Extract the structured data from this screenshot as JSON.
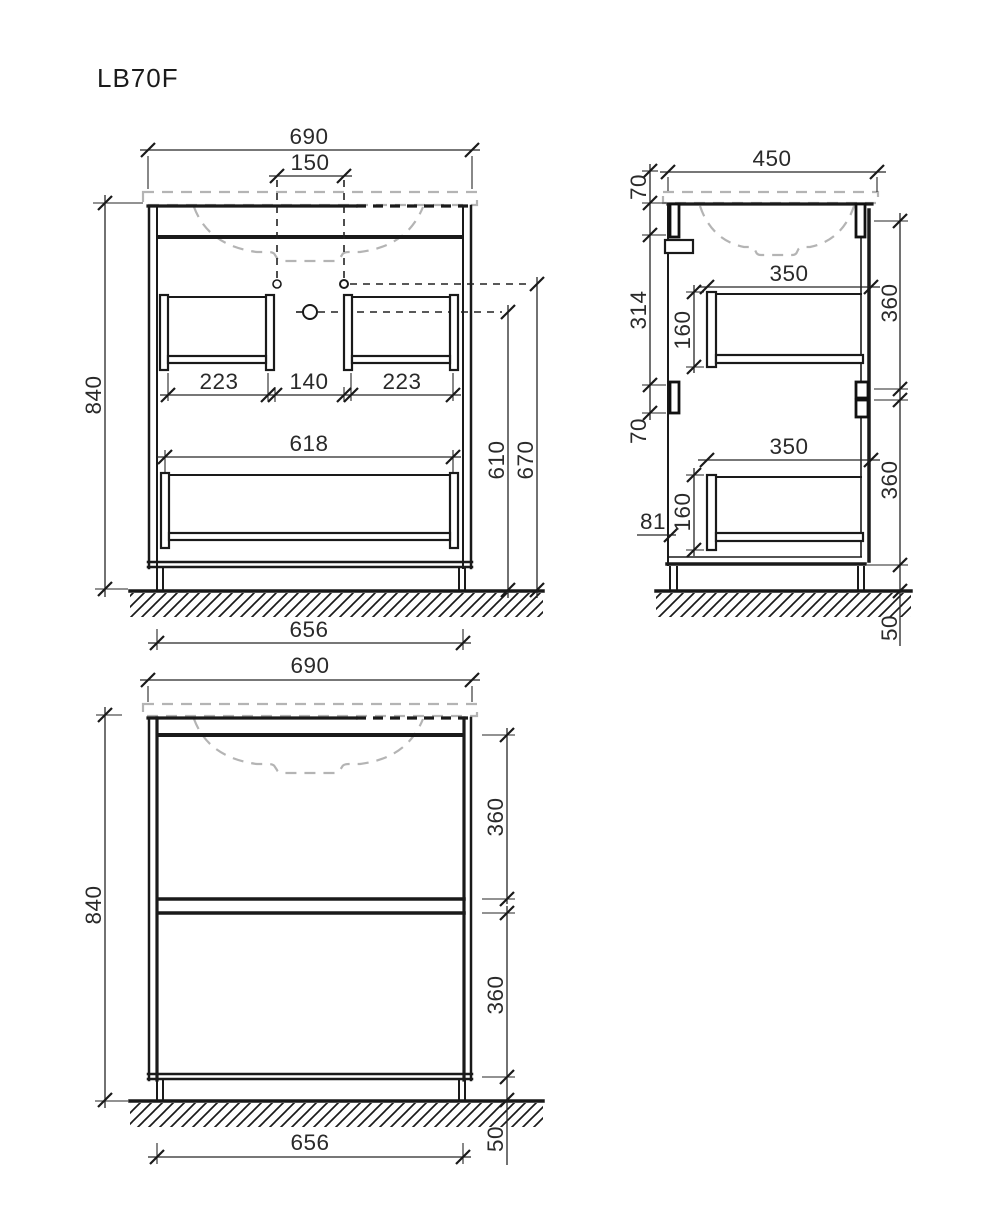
{
  "title": "LB70F",
  "colors": {
    "line": "#1a1a1a",
    "ghost_dash": "#b4b4b4",
    "text": "#2a2a2a",
    "background": "#ffffff"
  },
  "views": {
    "front_open": {
      "label": "front view with open drawers",
      "dims": {
        "overall_width": "690",
        "faucet_spacing": "150",
        "overall_height": "840",
        "drawer_left_width": "223",
        "center_gap": "140",
        "drawer_right_width": "223",
        "bottom_drawer_width": "618",
        "drain_hole_height": "610",
        "faucet_hole_height": "670",
        "base_width": "656"
      }
    },
    "side": {
      "label": "side view",
      "dims": {
        "overall_depth": "450",
        "basin_overhang": "70",
        "upper_section_height": "314",
        "upper_drawer_front": "160",
        "upper_drawer_depth": "350",
        "upper_drawer_zone": "360",
        "mid_gap": "70",
        "lower_drawer_depth": "350",
        "lower_drawer_front": "160",
        "drawer_bottom_offset": "81",
        "lower_drawer_zone": "360",
        "leg_height": "50"
      }
    },
    "front_closed": {
      "label": "front view with closed drawers",
      "dims": {
        "overall_width": "690",
        "overall_height": "840",
        "upper_drawer_height": "360",
        "lower_drawer_height": "360",
        "base_width": "656",
        "leg_height": "50"
      }
    }
  }
}
